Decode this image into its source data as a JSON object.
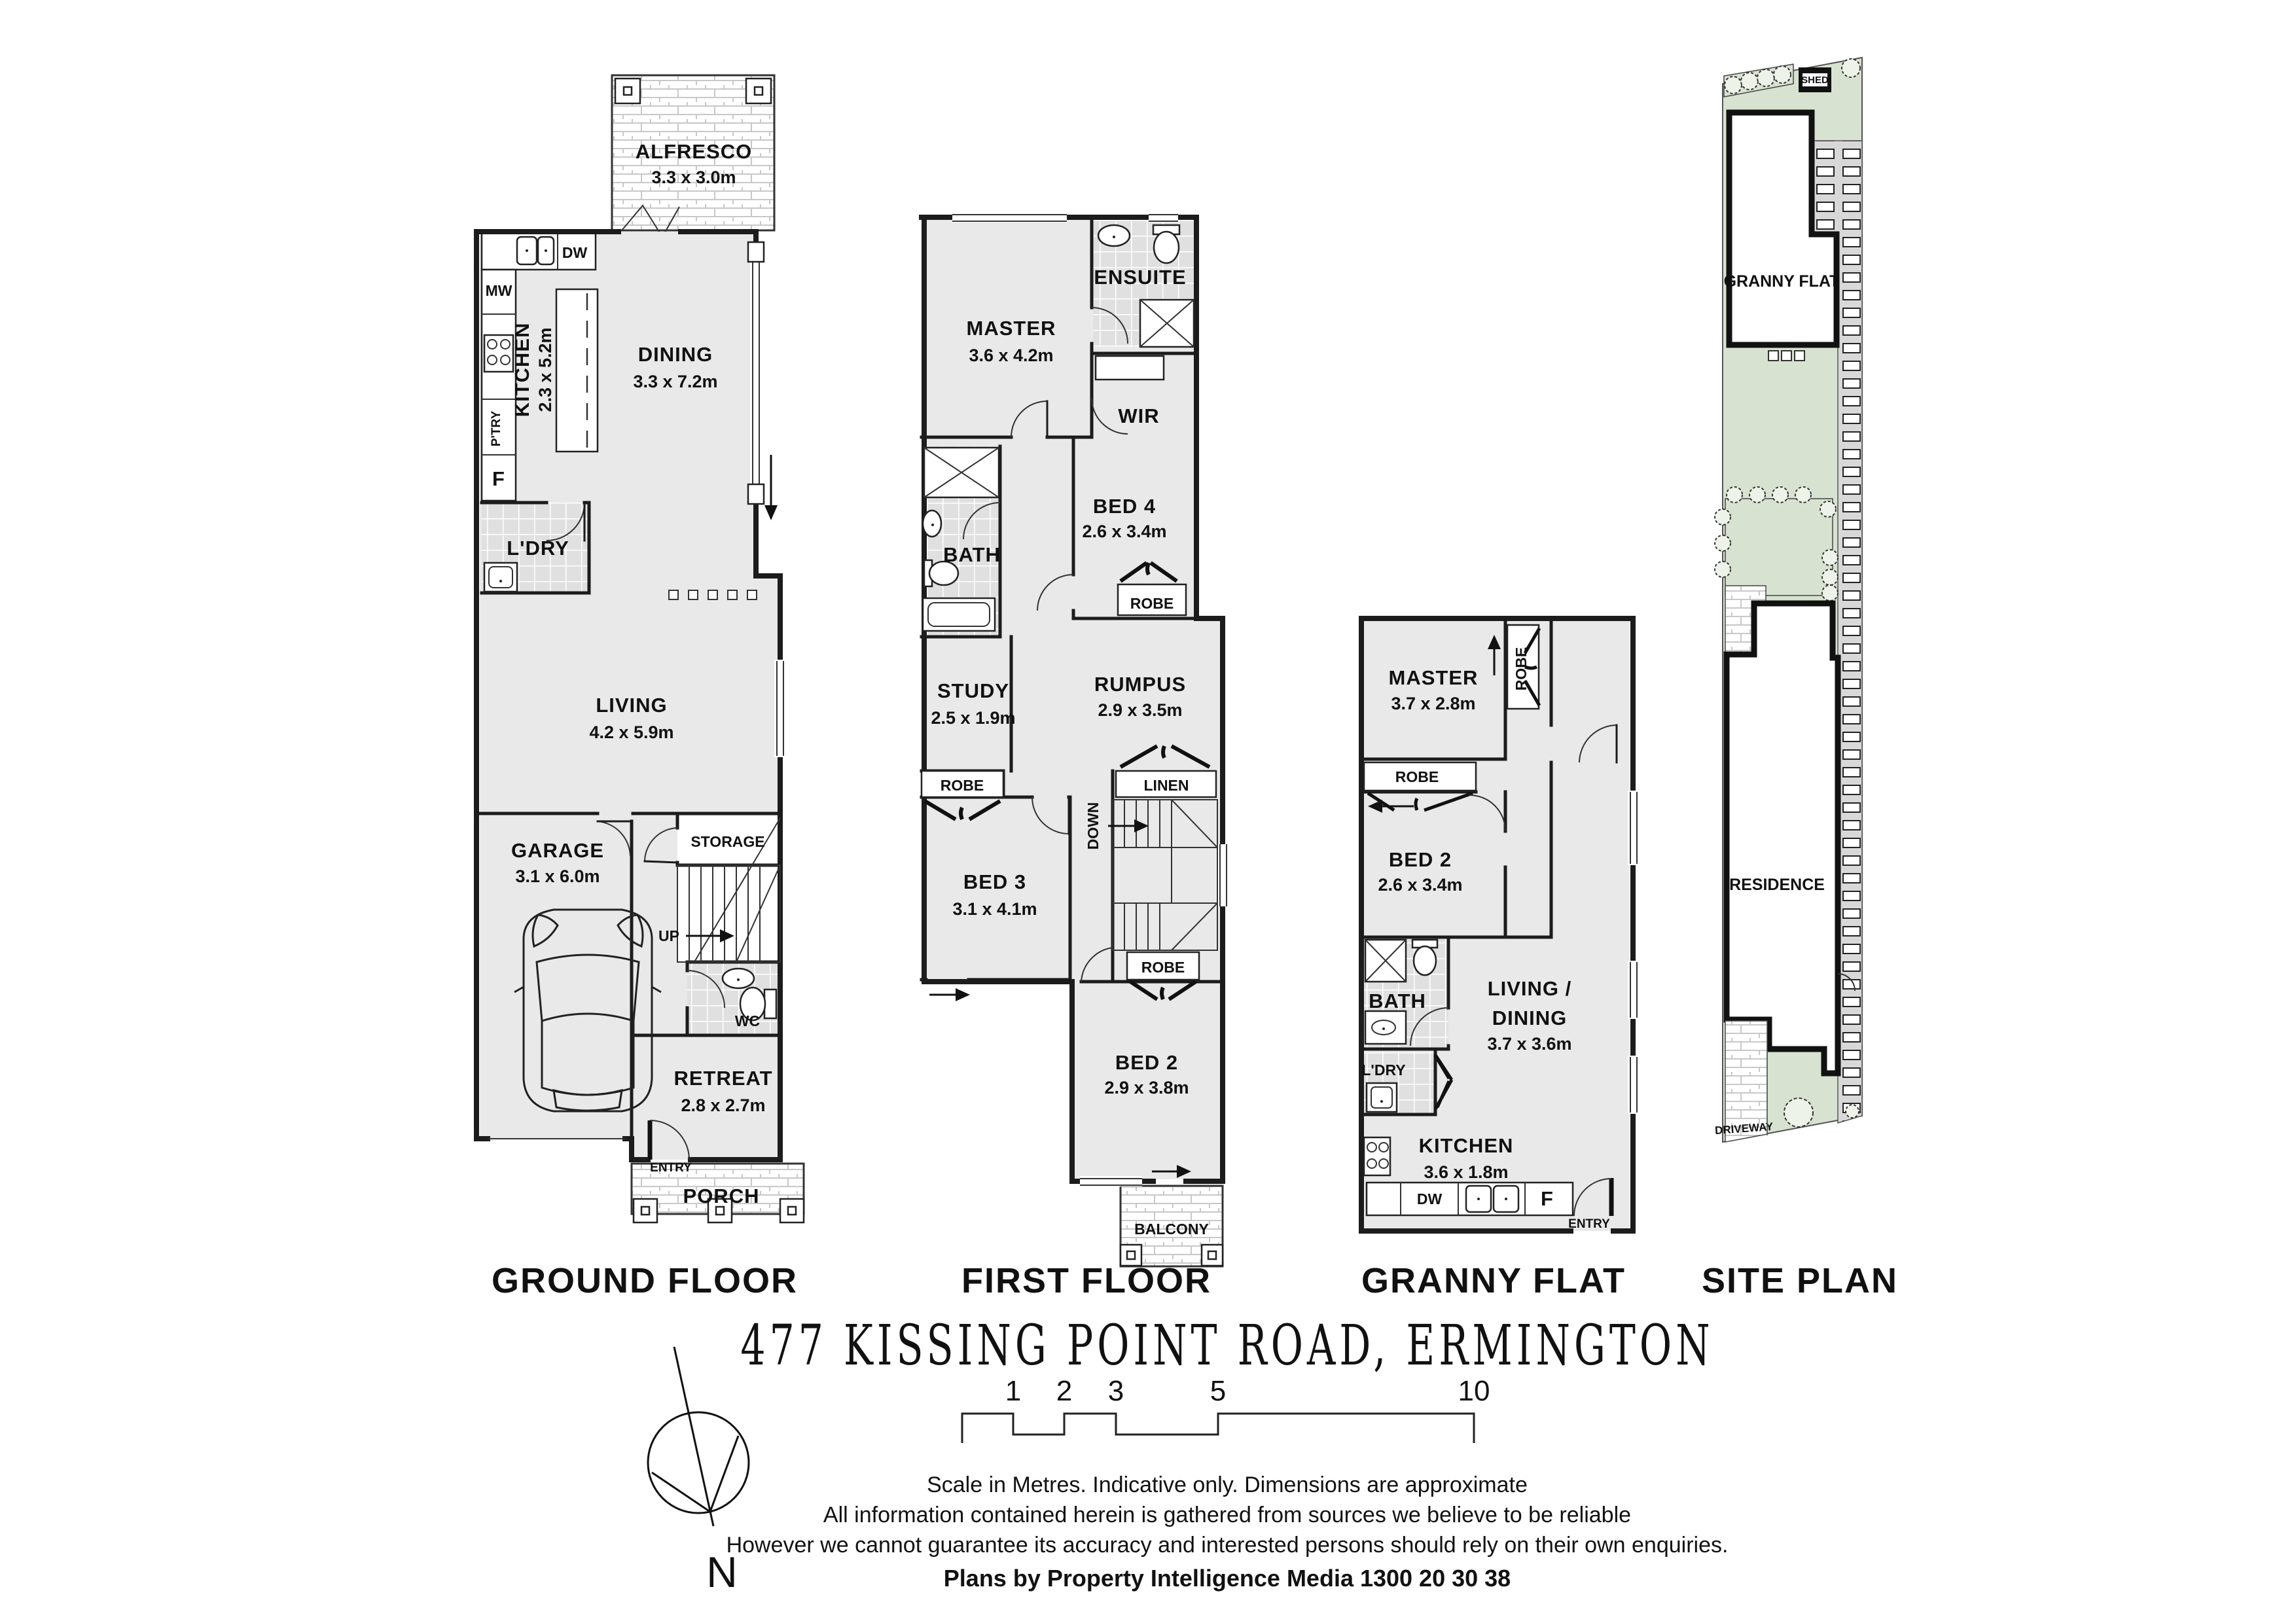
{
  "title": "477 KISSING POINT ROAD, ERMINGTON",
  "plans": {
    "ground": {
      "label": "GROUND FLOOR",
      "alfresco": {
        "name": "ALFRESCO",
        "dims": "3.3 x 3.0m"
      },
      "dining": {
        "name": "DINING",
        "dims": "3.3 x 7.2m"
      },
      "kitchen": {
        "name": "KITCHEN",
        "dims": "2.3 x 5.2m"
      },
      "dw": "DW",
      "mw": "MW",
      "ptry": "P'TRY",
      "fridge": "F",
      "ldry": "L'DRY",
      "living": {
        "name": "LIVING",
        "dims": "4.2 x 5.9m"
      },
      "garage": {
        "name": "GARAGE",
        "dims": "3.1 x 6.0m"
      },
      "storage": "STORAGE",
      "up": "UP",
      "wc": "WC",
      "retreat": {
        "name": "RETREAT",
        "dims": "2.8 x 2.7m"
      },
      "entry": "ENTRY",
      "porch": "PORCH"
    },
    "first": {
      "label": "FIRST FLOOR",
      "master": {
        "name": "MASTER",
        "dims": "3.6 x 4.2m"
      },
      "ensuite": "ENSUITE",
      "wir": "WIR",
      "bath": "BATH",
      "bed4": {
        "name": "BED 4",
        "dims": "2.6 x 3.4m"
      },
      "robe_bed4": "ROBE",
      "robe_bed3": "ROBE",
      "robe_bed2": "ROBE",
      "study": {
        "name": "STUDY",
        "dims": "2.5 x 1.9m"
      },
      "rumpus": {
        "name": "RUMPUS",
        "dims": "2.9 x 3.5m"
      },
      "linen": "LINEN",
      "down": "DOWN",
      "bed3": {
        "name": "BED 3",
        "dims": "3.1 x 4.1m"
      },
      "bed2": {
        "name": "BED 2",
        "dims": "2.9 x 3.8m"
      },
      "balcony": "BALCONY"
    },
    "granny": {
      "label": "GRANNY FLAT",
      "master": {
        "name": "MASTER",
        "dims": "3.7 x 2.8m"
      },
      "robe_master": "ROBE",
      "robe_bed2": "ROBE",
      "bed2": {
        "name": "BED 2",
        "dims": "2.6 x 3.4m"
      },
      "bath": "BATH",
      "ldry": "L'DRY",
      "living": {
        "name": "LIVING /",
        "name2": "DINING",
        "dims": "3.7 x 3.6m"
      },
      "kitchen": {
        "name": "KITCHEN",
        "dims": "3.6 x 1.8m"
      },
      "dw": "DW",
      "fridge": "F",
      "entry": "ENTRY"
    },
    "site": {
      "label": "SITE PLAN",
      "shed": "SHED",
      "granny": "GRANNY FLAT",
      "residence": "RESIDENCE",
      "driveway": "DRIVEWAY"
    }
  },
  "compass": {
    "north": "N"
  },
  "scalebar": {
    "ticks": [
      "1",
      "2",
      "3",
      "5",
      "10"
    ]
  },
  "footer": {
    "line1": "Scale in Metres. Indicative only. Dimensions are approximate",
    "line2": "All information contained herein is gathered from sources we believe to be reliable",
    "line3": "However we cannot guarantee its accuracy and interested persons should rely on their own enquiries.",
    "line4": "Plans by Property Intelligence Media 1300 20 30 38"
  },
  "colors": {
    "wall": "#1c1c1c",
    "room_fill": "#e9e9e9",
    "tile_fill": "#e0e0e0",
    "site_green": "#d7e2d0",
    "path_gray": "#d8d8d8",
    "brick_line": "#c8c8c8"
  }
}
